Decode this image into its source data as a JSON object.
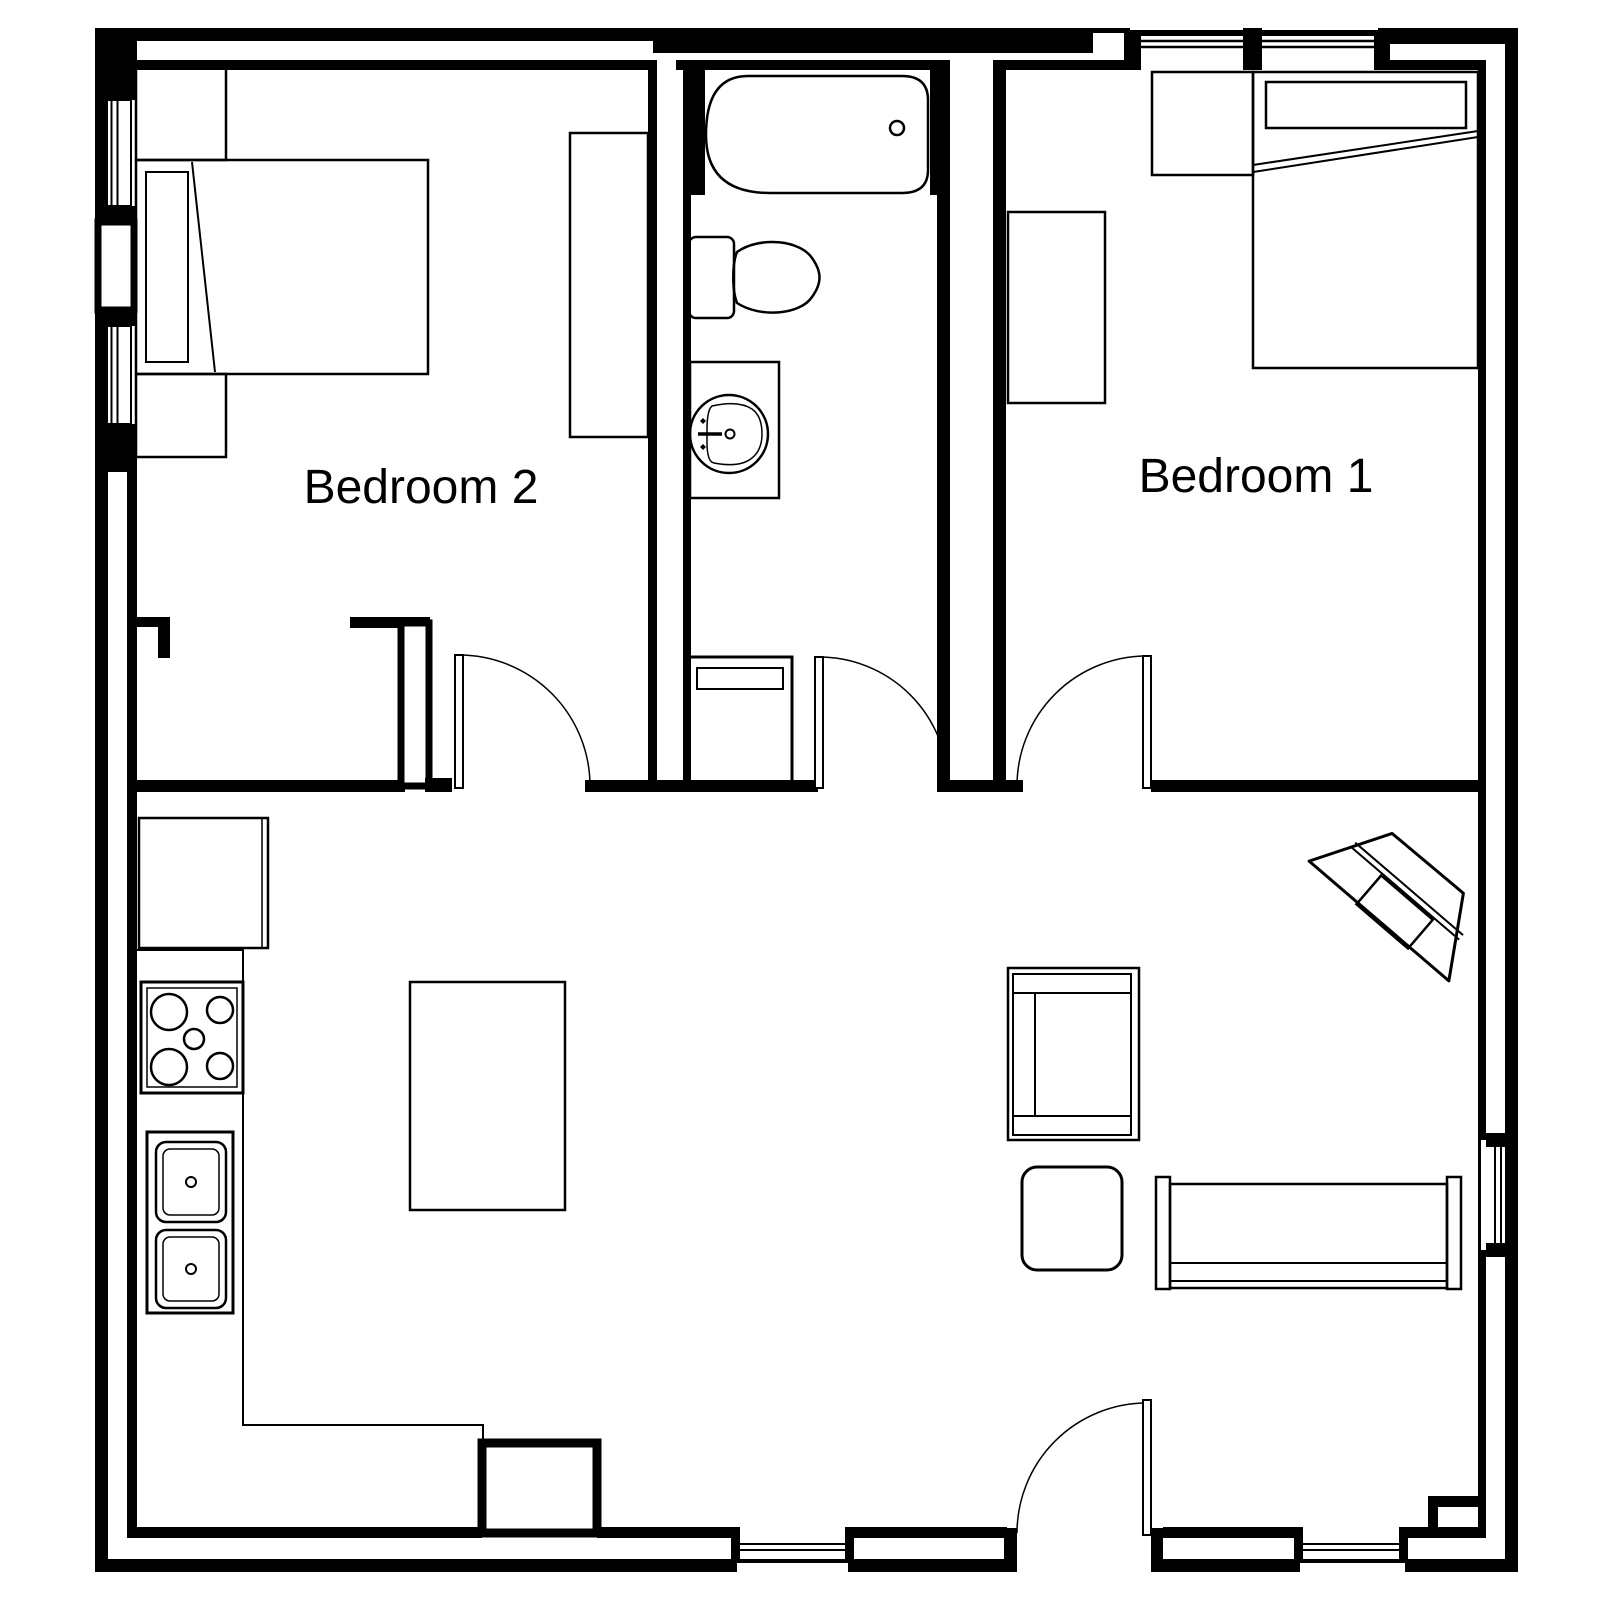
{
  "page": {
    "background_color": "#ffffff",
    "line_color": "#000000"
  },
  "floor_plan": {
    "rooms": {
      "bedroom2": {
        "label": "Bedroom 2"
      },
      "bedroom1": {
        "label": "Bedroom 1"
      }
    },
    "fixture_names": [
      "bathtub",
      "toilet",
      "bathroom-sink-vanity",
      "bathroom-cabinet",
      "bed",
      "pillow",
      "wardrobe",
      "dresser",
      "nightstand",
      "refrigerator",
      "stove",
      "double-kitchen-sink",
      "kitchen-island",
      "kitchen-peninsula",
      "sofa",
      "armchair",
      "side-table",
      "corner-tv-console",
      "interior-door",
      "entry-door",
      "window"
    ]
  }
}
